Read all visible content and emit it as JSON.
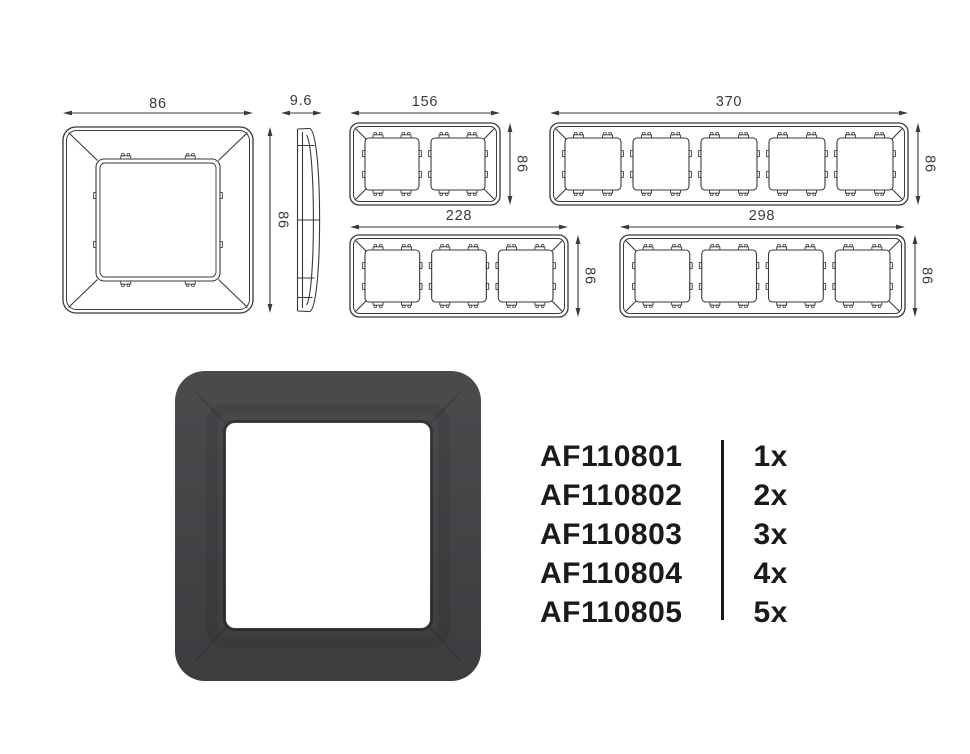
{
  "technical_drawings": {
    "front_single": {
      "width_label": "86",
      "height_label": "86"
    },
    "side_profile": {
      "depth_label": "9.6"
    },
    "front_2gang": {
      "width_label": "156",
      "height_label": "86"
    },
    "front_5gang": {
      "width_label": "370",
      "height_label": "86"
    },
    "front_3gang": {
      "width_label": "228",
      "height_label": "86"
    },
    "front_4gang": {
      "width_label": "298",
      "height_label": "86"
    }
  },
  "product_table": {
    "rows": [
      {
        "code": "AF110801",
        "quantity": "1x"
      },
      {
        "code": "AF110802",
        "quantity": "2x"
      },
      {
        "code": "AF110803",
        "quantity": "3x"
      },
      {
        "code": "AF110804",
        "quantity": "4x"
      },
      {
        "code": "AF110805",
        "quantity": "5x"
      }
    ]
  },
  "colors": {
    "line": "#3a3a3c",
    "dimension_text": "#3a3a3c",
    "list_text": "#1a1a1b",
    "frame_dark_top": "#4b4b4e",
    "frame_dark_bottom": "#3d3d40",
    "opening": "#ffffff",
    "background": "#ffffff"
  }
}
